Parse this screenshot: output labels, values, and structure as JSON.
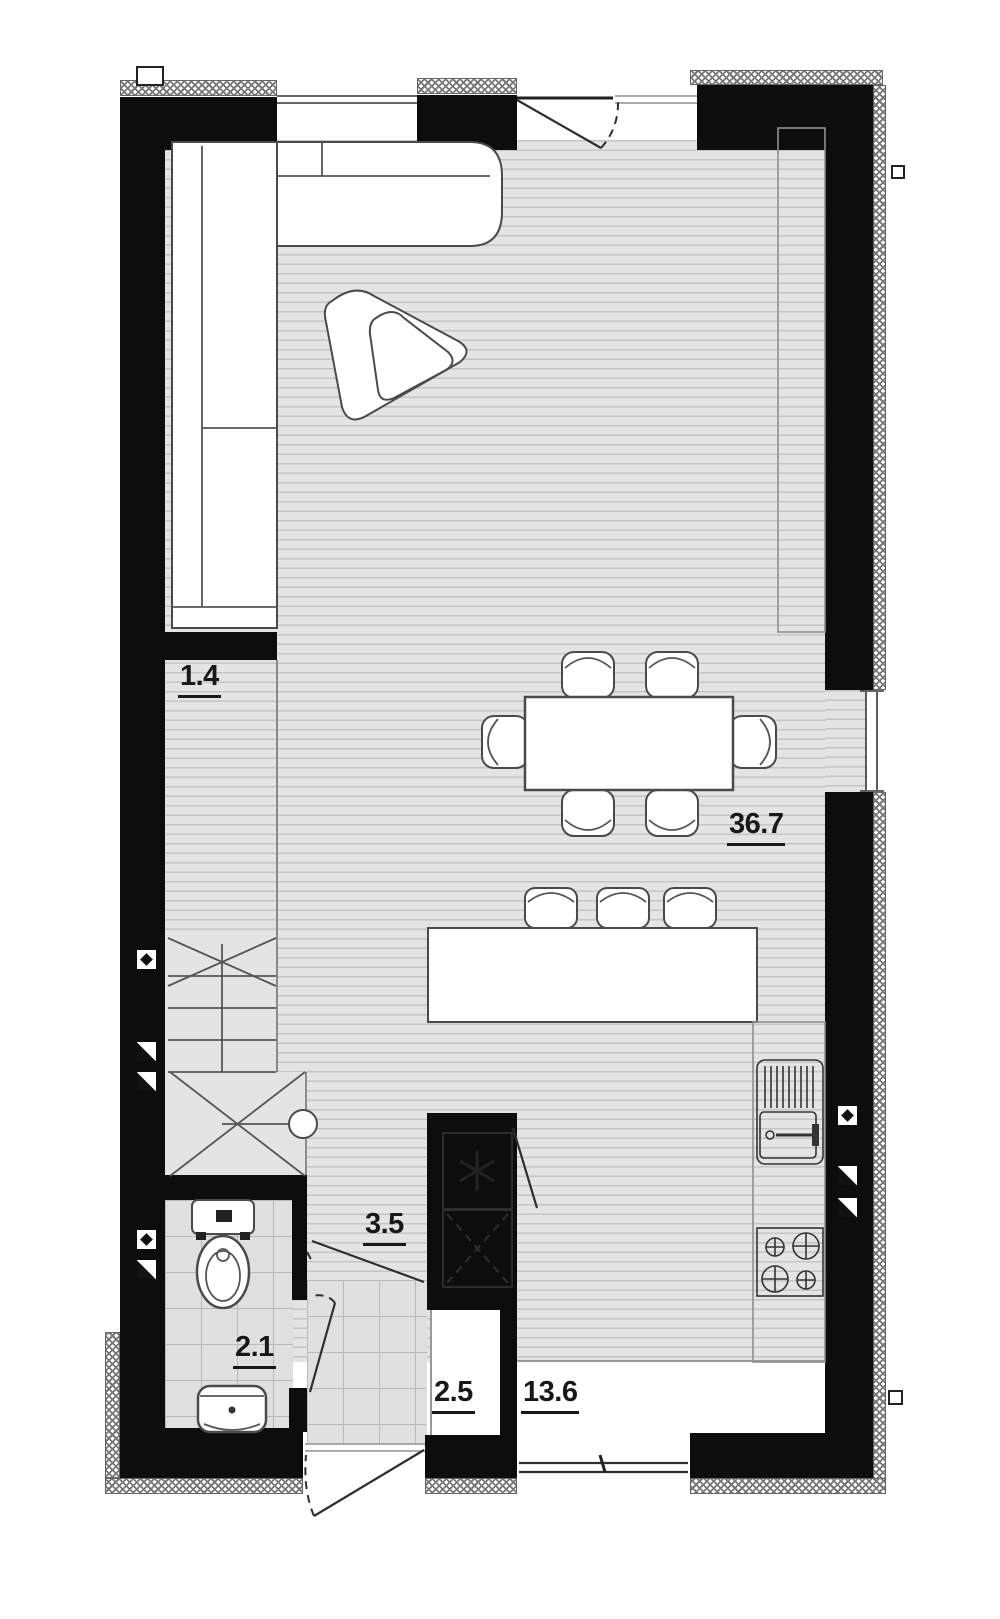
{
  "floorplan": {
    "area_labels": {
      "corridor": "1.4",
      "living_kitchen": "36.7",
      "hallway": "3.5",
      "bathroom": "2.1",
      "vestibule": "2.5",
      "terrace": "13.6"
    },
    "colors": {
      "wall": "#0d0d0d",
      "floor": "#e4e4e4",
      "floor_line": "#c5c5c5",
      "tile_line": "#b9b9b9",
      "furniture_outline": "#4a4a4a",
      "background": "#ffffff"
    },
    "fixtures": [
      "corner-sofa",
      "pouf",
      "dining-table",
      "dining-chair",
      "bar-stool",
      "kitchen-island",
      "kitchen-counter",
      "kitchen-sink",
      "stove",
      "boiler-unit",
      "appliance-unit",
      "toilet",
      "washbasin",
      "stairs",
      "door-swing",
      "window",
      "wardrobe"
    ]
  }
}
